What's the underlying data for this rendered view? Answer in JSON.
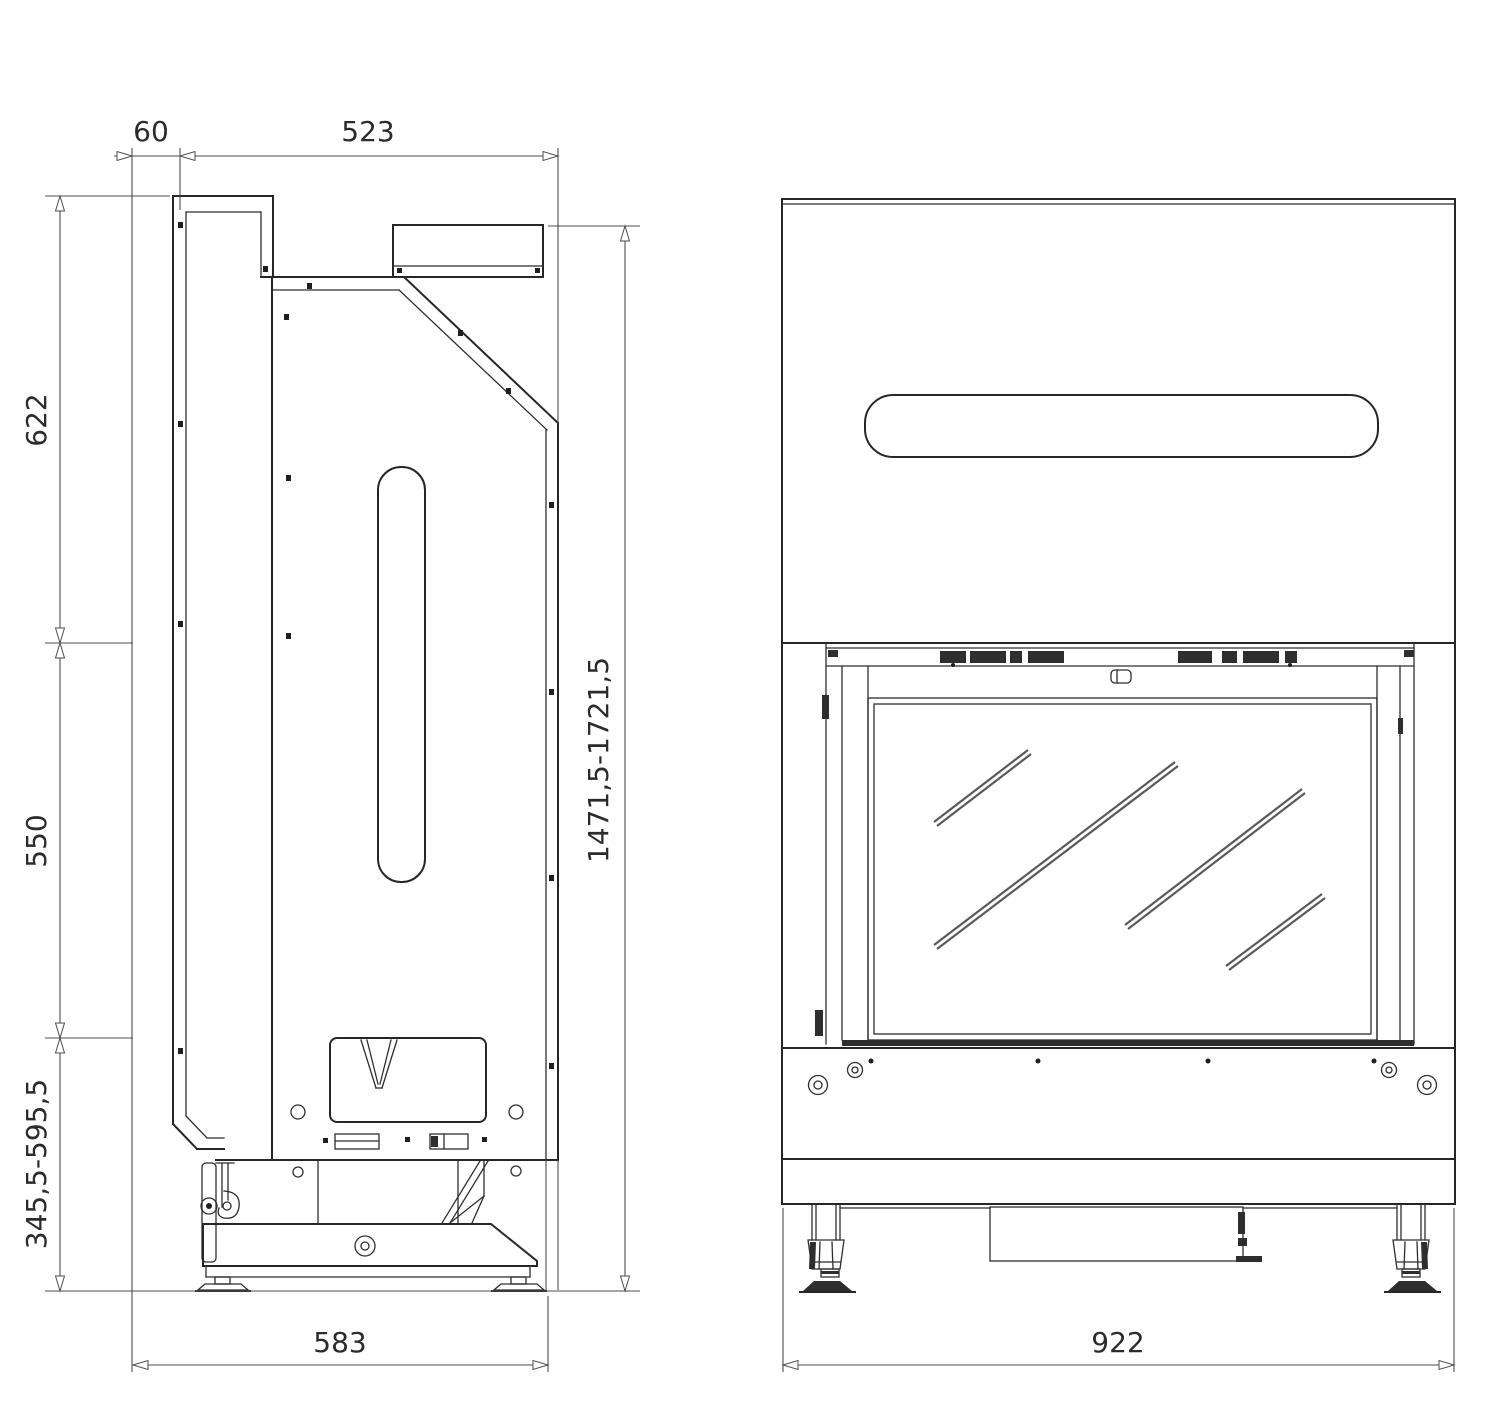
{
  "drawing": {
    "background": "#ffffff",
    "line_color": "#262626",
    "dimension_color": "#4d4d4d",
    "dark_fill": "#2e2e2e",
    "glass_reflection_color": "#5a5a5a"
  },
  "dimensions": {
    "rear_gap": {
      "label": "60",
      "orientation": "horizontal"
    },
    "body_depth": {
      "label": "523",
      "orientation": "horizontal"
    },
    "upper_section_height": {
      "label": "622",
      "orientation": "vertical"
    },
    "middle_section_height": {
      "label": "550",
      "orientation": "vertical"
    },
    "base_height_range": {
      "label": "345,5-595,5",
      "orientation": "vertical"
    },
    "overall_height_range": {
      "label": "1471,5-1721,5",
      "orientation": "vertical"
    },
    "overall_depth": {
      "label": "583",
      "orientation": "horizontal"
    },
    "overall_width": {
      "label": "922",
      "orientation": "horizontal"
    }
  }
}
